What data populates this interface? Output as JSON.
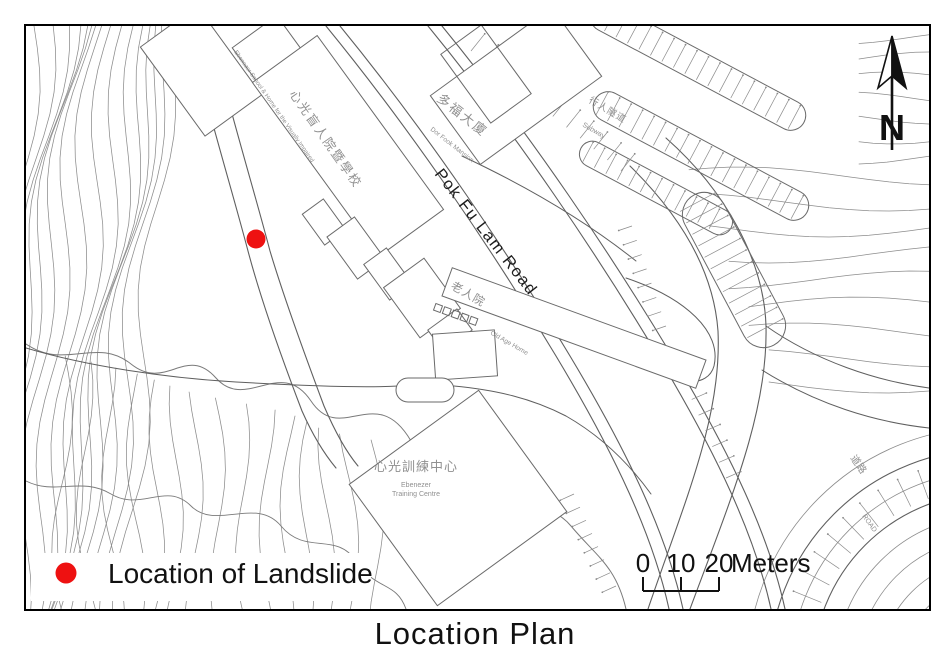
{
  "title": "Location Plan",
  "map": {
    "labels": {
      "road_main": "Pok Fu Lam Road",
      "school": {
        "zh": "心光盲人院暨學校",
        "en": "Ebenezer School & Home for the Visually Impaired"
      },
      "mansion": {
        "zh": "多福大廈",
        "en": "Dor Fook Mansion"
      },
      "subway": {
        "zh": "行人隧道",
        "en": "Subway"
      },
      "old_age_home": {
        "zh": "老人院",
        "en": "Old Age Home"
      },
      "training_centre": {
        "zh": "心光訓練中心",
        "en_line1": "Ebenezer",
        "en_line2": "Training Centre"
      },
      "road_side": {
        "zh": "道路",
        "en": "ROAD"
      }
    },
    "north_arrow": {
      "letter": "N"
    },
    "scale_bar": {
      "tick0": "0",
      "tick1": "10",
      "tick2": "20",
      "unit": "Meters"
    },
    "legend": {
      "label": "Location of Landslide"
    },
    "marker": {
      "color": "#ee1111"
    }
  }
}
